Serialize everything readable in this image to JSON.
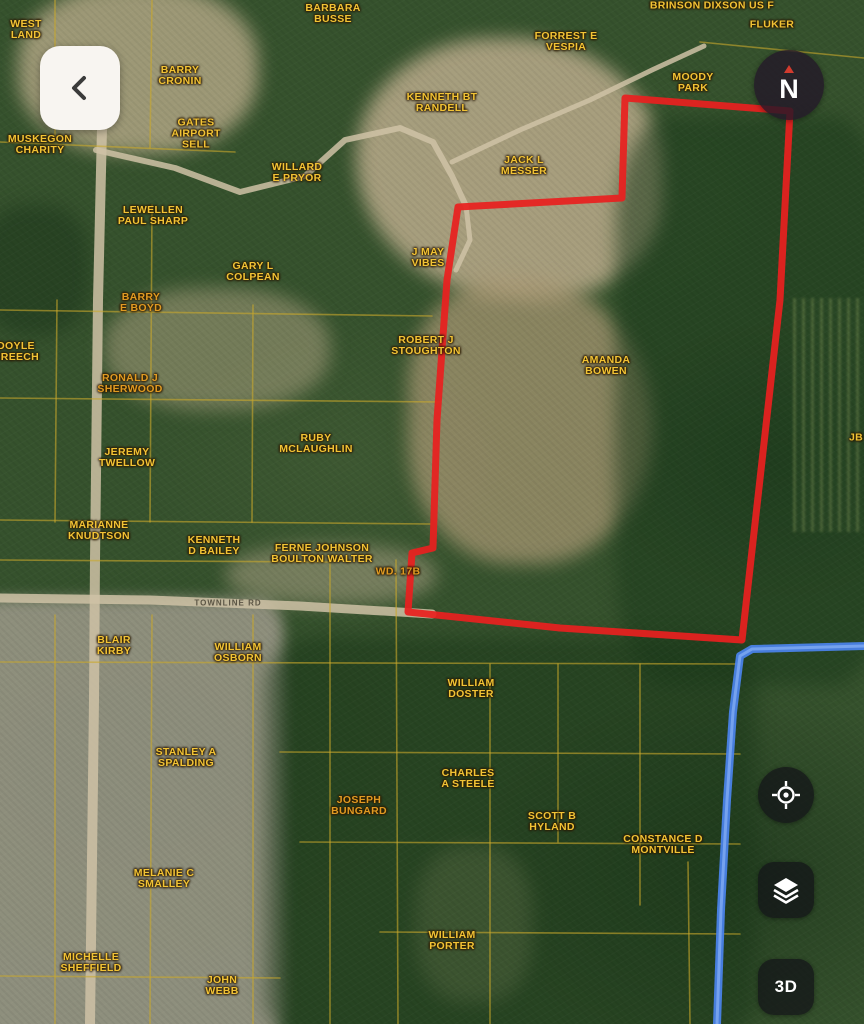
{
  "app": {
    "back_button": {
      "icon": "chevron-left-icon"
    },
    "compass": {
      "label": "N"
    },
    "map_controls": [
      {
        "id": "locate",
        "icon": "crosshair-icon",
        "label": ""
      },
      {
        "id": "layers",
        "icon": "layers-icon",
        "label": ""
      },
      {
        "id": "view-3d",
        "icon": "",
        "label": "3D"
      }
    ]
  },
  "colors": {
    "label_yellow": "#f2c335",
    "label_orange": "#e09a22",
    "boundary_red": "#e8201f",
    "highway_blue": "#4a82e8",
    "highway_blue_core": "#7aa6f0",
    "road_tan": "#cfc2a6",
    "parcel_line_yellow": "#c9a82c"
  },
  "map": {
    "parcel_labels": [
      {
        "id": "west-land",
        "x": 26,
        "y": 30,
        "lines": [
          "WEST",
          "LAND"
        ]
      },
      {
        "id": "muskegon-charity",
        "x": 40,
        "y": 145,
        "lines": [
          "MUSKEGON",
          "CHARITY"
        ]
      },
      {
        "id": "barbara-busse",
        "x": 333,
        "y": 14,
        "lines": [
          "BARBARA",
          "BUSSE"
        ]
      },
      {
        "id": "dixson-us-f",
        "x": 712,
        "y": 6,
        "lines": [
          "BRINSON DIXSON US F"
        ]
      },
      {
        "id": "fluker",
        "x": 772,
        "y": 25,
        "lines": [
          "FLUKER"
        ]
      },
      {
        "id": "forrest-vespia",
        "x": 566,
        "y": 42,
        "lines": [
          "FORREST E",
          "VESPIA"
        ]
      },
      {
        "id": "moody-park",
        "x": 693,
        "y": 83,
        "lines": [
          "MOODY",
          "PARK"
        ]
      },
      {
        "id": "barry-cronin",
        "x": 180,
        "y": 76,
        "lines": [
          "BARRY",
          "CRONIN"
        ]
      },
      {
        "id": "gates-airport",
        "x": 196,
        "y": 134,
        "lines": [
          "GATES",
          "AIRPORT",
          "SELL"
        ]
      },
      {
        "id": "kenneth-randell",
        "x": 442,
        "y": 103,
        "lines": [
          "KENNETH BT",
          "RANDELL"
        ]
      },
      {
        "id": "jack-messer",
        "x": 524,
        "y": 166,
        "lines": [
          "JACK L",
          "MESSER"
        ]
      },
      {
        "id": "willard-pryor",
        "x": 297,
        "y": 173,
        "lines": [
          "WILLARD",
          "E PRYOR"
        ]
      },
      {
        "id": "lewellen-sharp",
        "x": 153,
        "y": 216,
        "lines": [
          "LEWELLEN",
          "PAUL SHARP"
        ]
      },
      {
        "id": "gary-colpean",
        "x": 253,
        "y": 272,
        "lines": [
          "GARY L",
          "COLPEAN"
        ]
      },
      {
        "id": "barry-boyd",
        "x": 141,
        "y": 303,
        "tone": "orange",
        "lines": [
          "BARRY",
          "E BOYD"
        ]
      },
      {
        "id": "j-may-vibes",
        "x": 428,
        "y": 258,
        "lines": [
          "J MAY",
          "VIBES"
        ]
      },
      {
        "id": "doyle-creech",
        "x": 16,
        "y": 352,
        "lines": [
          "DOYLE",
          "CREECH"
        ]
      },
      {
        "id": "ronald-sherwood",
        "x": 130,
        "y": 384,
        "tone": "orange",
        "lines": [
          "RONALD J",
          "SHERWOOD"
        ]
      },
      {
        "id": "robert-stoughton",
        "x": 426,
        "y": 346,
        "lines": [
          "ROBERT J",
          "STOUGHTON"
        ]
      },
      {
        "id": "amanda-bowen",
        "x": 606,
        "y": 366,
        "lines": [
          "AMANDA",
          "BOWEN"
        ]
      },
      {
        "id": "jeremy-twellow",
        "x": 127,
        "y": 458,
        "lines": [
          "JEREMY",
          "TWELLOW"
        ]
      },
      {
        "id": "ruby-mclaughlin",
        "x": 316,
        "y": 444,
        "lines": [
          "RUBY",
          "MCLAUGHLIN"
        ]
      },
      {
        "id": "marianne-knudtson",
        "x": 99,
        "y": 531,
        "lines": [
          "MARIANNE",
          "KNUDTSON"
        ]
      },
      {
        "id": "kenneth-bailey",
        "x": 214,
        "y": 546,
        "lines": [
          "KENNETH",
          "D BAILEY"
        ]
      },
      {
        "id": "ferne-boulton",
        "x": 322,
        "y": 554,
        "lines": [
          "FERNE JOHNSON",
          "BOULTON WALTER"
        ]
      },
      {
        "id": "wd-17b",
        "x": 398,
        "y": 572,
        "tone": "orange",
        "lines": [
          "WD. 17B"
        ]
      },
      {
        "id": "blair-kirby",
        "x": 114,
        "y": 646,
        "lines": [
          "BLAIR",
          "KIRBY"
        ]
      },
      {
        "id": "william-osborn",
        "x": 238,
        "y": 653,
        "lines": [
          "WILLIAM",
          "OSBORN"
        ]
      },
      {
        "id": "william-doster",
        "x": 471,
        "y": 689,
        "lines": [
          "WILLIAM",
          "DOSTER"
        ]
      },
      {
        "id": "stanley-spalding",
        "x": 186,
        "y": 758,
        "lines": [
          "STANLEY A",
          "SPALDING"
        ]
      },
      {
        "id": "charles-steele",
        "x": 468,
        "y": 779,
        "lines": [
          "CHARLES",
          "A STEELE"
        ]
      },
      {
        "id": "joseph-bungard",
        "x": 359,
        "y": 806,
        "tone": "orange",
        "lines": [
          "JOSEPH",
          "BUNGARD"
        ]
      },
      {
        "id": "scott-hyland",
        "x": 552,
        "y": 822,
        "lines": [
          "SCOTT B",
          "HYLAND"
        ]
      },
      {
        "id": "constance-montville",
        "x": 663,
        "y": 845,
        "lines": [
          "CONSTANCE D",
          "MONTVILLE"
        ]
      },
      {
        "id": "melanie-smalley",
        "x": 164,
        "y": 879,
        "lines": [
          "MELANIE C",
          "SMALLEY"
        ]
      },
      {
        "id": "michelle-sheffield",
        "x": 91,
        "y": 963,
        "lines": [
          "MICHELLE",
          "SHEFFIELD"
        ]
      },
      {
        "id": "john-webb",
        "x": 222,
        "y": 986,
        "lines": [
          "JOHN",
          "WEBB"
        ]
      },
      {
        "id": "william-porter",
        "x": 452,
        "y": 941,
        "lines": [
          "WILLIAM",
          "PORTER"
        ]
      },
      {
        "id": "edge-partial",
        "x": 856,
        "y": 438,
        "lines": [
          "JB"
        ]
      }
    ],
    "road_labels": [
      {
        "id": "townline-rd",
        "text": "TOWNLINE RD",
        "x": 228,
        "y": 603
      }
    ],
    "selected_parcel_boundary": {
      "points": [
        [
          625,
          98
        ],
        [
          790,
          111
        ],
        [
          780,
          300
        ],
        [
          742,
          640
        ],
        [
          560,
          628
        ],
        [
          408,
          612
        ],
        [
          412,
          553
        ],
        [
          433,
          548
        ],
        [
          437,
          420
        ],
        [
          447,
          280
        ],
        [
          458,
          207
        ],
        [
          622,
          198
        ]
      ],
      "width": 7
    },
    "highway": {
      "points": [
        [
          864,
          646
        ],
        [
          752,
          649
        ],
        [
          740,
          656
        ],
        [
          733,
          712
        ],
        [
          727,
          800
        ],
        [
          721,
          910
        ],
        [
          717,
          1024
        ]
      ],
      "width": 8
    },
    "tan_roads": [
      {
        "points": [
          [
            102,
            128
          ],
          [
            98,
            300
          ],
          [
            95,
            560
          ],
          [
            94,
            700
          ],
          [
            92,
            860
          ],
          [
            90,
            1024
          ]
        ],
        "width": 10
      },
      {
        "points": [
          [
            0,
            598
          ],
          [
            150,
            600
          ],
          [
            300,
            606
          ],
          [
            432,
            614
          ]
        ],
        "width": 9
      },
      {
        "points": [
          [
            96,
            150
          ],
          [
            175,
            168
          ],
          [
            240,
            192
          ],
          [
            305,
            176
          ],
          [
            345,
            140
          ],
          [
            400,
            128
          ],
          [
            433,
            142
          ],
          [
            452,
            176
          ],
          [
            466,
            206
          ]
        ],
        "width": 6
      },
      {
        "points": [
          [
            452,
            162
          ],
          [
            520,
            130
          ],
          [
            590,
            100
          ],
          [
            652,
            70
          ],
          [
            704,
            46
          ]
        ],
        "width": 5
      },
      {
        "points": [
          [
            466,
            206
          ],
          [
            470,
            240
          ],
          [
            456,
            270
          ]
        ],
        "width": 5
      }
    ],
    "parcel_lines": [
      {
        "points": [
          [
            55,
            0
          ],
          [
            55,
            140
          ]
        ]
      },
      {
        "points": [
          [
            152,
            0
          ],
          [
            150,
            148
          ]
        ]
      },
      {
        "points": [
          [
            0,
            142
          ],
          [
            235,
            152
          ]
        ]
      },
      {
        "points": [
          [
            0,
            310
          ],
          [
            432,
            316
          ]
        ]
      },
      {
        "points": [
          [
            0,
            398
          ],
          [
            440,
            402
          ]
        ]
      },
      {
        "points": [
          [
            57,
            300
          ],
          [
            55,
            522
          ]
        ]
      },
      {
        "points": [
          [
            152,
            205
          ],
          [
            150,
            522
          ]
        ]
      },
      {
        "points": [
          [
            253,
            305
          ],
          [
            252,
            522
          ]
        ]
      },
      {
        "points": [
          [
            0,
            520
          ],
          [
            430,
            524
          ]
        ]
      },
      {
        "points": [
          [
            0,
            560
          ],
          [
            330,
            562
          ]
        ]
      },
      {
        "points": [
          [
            330,
            560
          ],
          [
            330,
            1024
          ]
        ]
      },
      {
        "points": [
          [
            396,
            560
          ],
          [
            398,
            1024
          ]
        ]
      },
      {
        "points": [
          [
            0,
            662
          ],
          [
            740,
            664
          ]
        ]
      },
      {
        "points": [
          [
            253,
            615
          ],
          [
            253,
            1024
          ]
        ]
      },
      {
        "points": [
          [
            152,
            615
          ],
          [
            150,
            1024
          ]
        ]
      },
      {
        "points": [
          [
            55,
            615
          ],
          [
            55,
            1024
          ]
        ]
      },
      {
        "points": [
          [
            490,
            664
          ],
          [
            490,
            1024
          ]
        ]
      },
      {
        "points": [
          [
            558,
            664
          ],
          [
            558,
            842
          ]
        ]
      },
      {
        "points": [
          [
            640,
            664
          ],
          [
            640,
            905
          ]
        ]
      },
      {
        "points": [
          [
            688,
            862
          ],
          [
            690,
            1024
          ]
        ]
      },
      {
        "points": [
          [
            280,
            752
          ],
          [
            740,
            754
          ]
        ]
      },
      {
        "points": [
          [
            300,
            842
          ],
          [
            740,
            844
          ]
        ]
      },
      {
        "points": [
          [
            380,
            932
          ],
          [
            740,
            934
          ]
        ]
      },
      {
        "points": [
          [
            0,
            976
          ],
          [
            280,
            978
          ]
        ]
      },
      {
        "points": [
          [
            700,
            42
          ],
          [
            864,
            58
          ]
        ]
      }
    ]
  }
}
